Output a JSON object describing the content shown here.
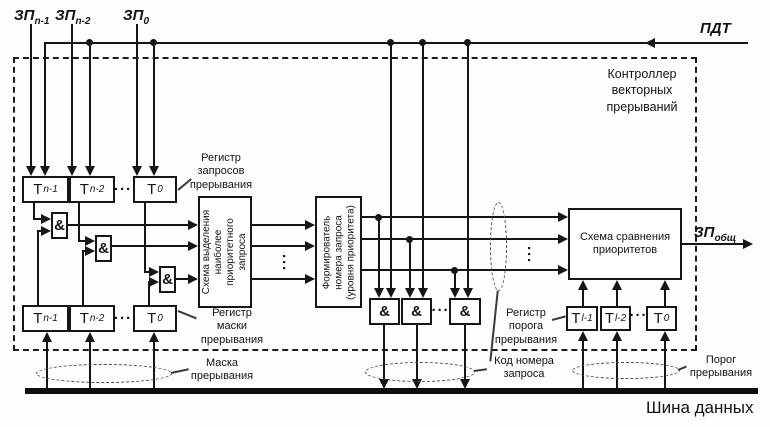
{
  "diagram_title": "Контроллер векторных прерываний",
  "signals": {
    "zp_inputs": [
      {
        "base": "ЗП",
        "sub": "n-1"
      },
      {
        "base": "ЗП",
        "sub": "n-2"
      },
      {
        "base": "ЗП",
        "sub": "0"
      }
    ],
    "pdt": "ПДТ",
    "zp_common": {
      "base": "ЗП",
      "sub": "общ"
    }
  },
  "controller": {
    "lines": [
      "Контроллер",
      "векторных",
      "прерываний"
    ]
  },
  "request_register": {
    "label_lines": [
      "Регистр",
      "запросов",
      "прерывания"
    ],
    "cells": [
      {
        "base": "Т",
        "sub": "n-1"
      },
      {
        "base": "Т",
        "sub": "n-2"
      },
      {
        "base": "Т",
        "sub": "0"
      }
    ]
  },
  "mask_register": {
    "label_lines": [
      "Регистр",
      "маски",
      "прерывания"
    ],
    "cells": [
      {
        "base": "Т",
        "sub": "n-1"
      },
      {
        "base": "Т",
        "sub": "n-2"
      },
      {
        "base": "Т",
        "sub": "0"
      }
    ]
  },
  "threshold_register": {
    "label_lines": [
      "Регистр",
      "порога",
      "прерывания"
    ],
    "cells": [
      {
        "base": "Т",
        "sub": "l-1"
      },
      {
        "base": "Т",
        "sub": "l-2"
      },
      {
        "base": "Т",
        "sub": "0"
      }
    ]
  },
  "blocks": {
    "selector": {
      "lines": [
        "Схема выделения",
        "наиболее",
        "приоритетного",
        "запроса"
      ]
    },
    "former": {
      "lines": [
        "Формирователь",
        "номера запроса",
        "(уровня приоритета)"
      ]
    },
    "comparator": {
      "lines": [
        "Схема сравнения",
        "приоритетов"
      ]
    },
    "and_gate": "&"
  },
  "bus": {
    "label": "Шина данных"
  },
  "groups": {
    "mask": {
      "lines": [
        "Маска",
        "прерывания"
      ]
    },
    "code": {
      "lines": [
        "Код номера",
        "запроса"
      ]
    },
    "threshold": {
      "lines": [
        "Порог",
        "прерывания"
      ]
    }
  },
  "dots": {
    "h": "···",
    "v": "···"
  }
}
